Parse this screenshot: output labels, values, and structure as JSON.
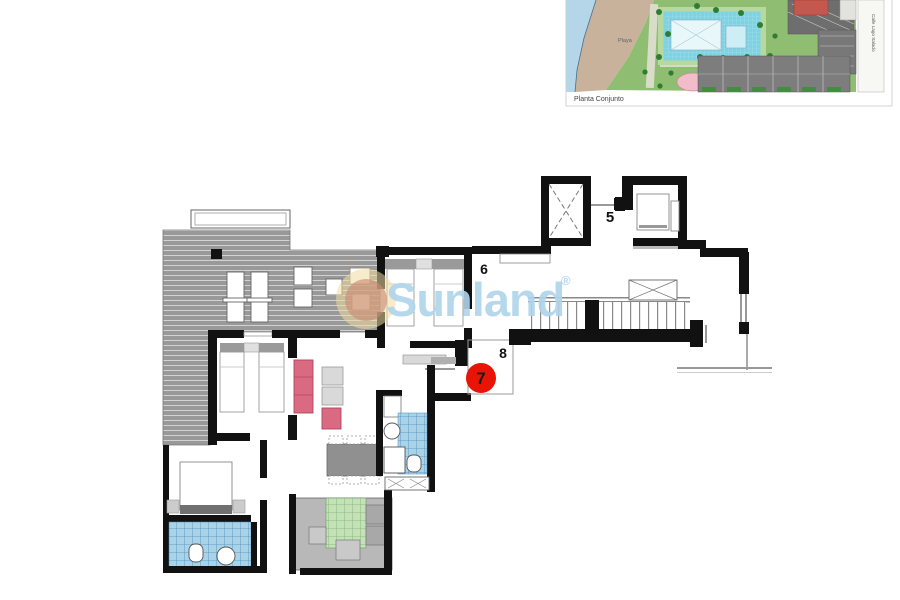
{
  "watermark": {
    "brand": "Sunland",
    "registered": "®",
    "text_color": "#afd4ec",
    "sun_outer_color": "#eeda9e",
    "sun_inner_color": "#c98a72"
  },
  "site_plan": {
    "caption": "Planta Conjunto",
    "beach_label": "Playa",
    "street_label": "Calle Lago Salado",
    "colors": {
      "water": "#b5d6e8",
      "sand": "#c9b29b",
      "grass": "#8fbd72",
      "pool": "#7fd2e2",
      "building": "#6f6f6f",
      "accent_building": "#c4574e",
      "leisure_pool": "#f2bccb"
    }
  },
  "floor_plan": {
    "unit_labels": {
      "unit5": "5",
      "unit6": "6",
      "unit8": "8"
    },
    "unit_badge": {
      "label": "7",
      "color": "#e81507"
    },
    "wall_color": "#111111",
    "tile_colors": {
      "bathroom": "#a9d3e8",
      "kitchen": "#c3e2b6"
    }
  }
}
